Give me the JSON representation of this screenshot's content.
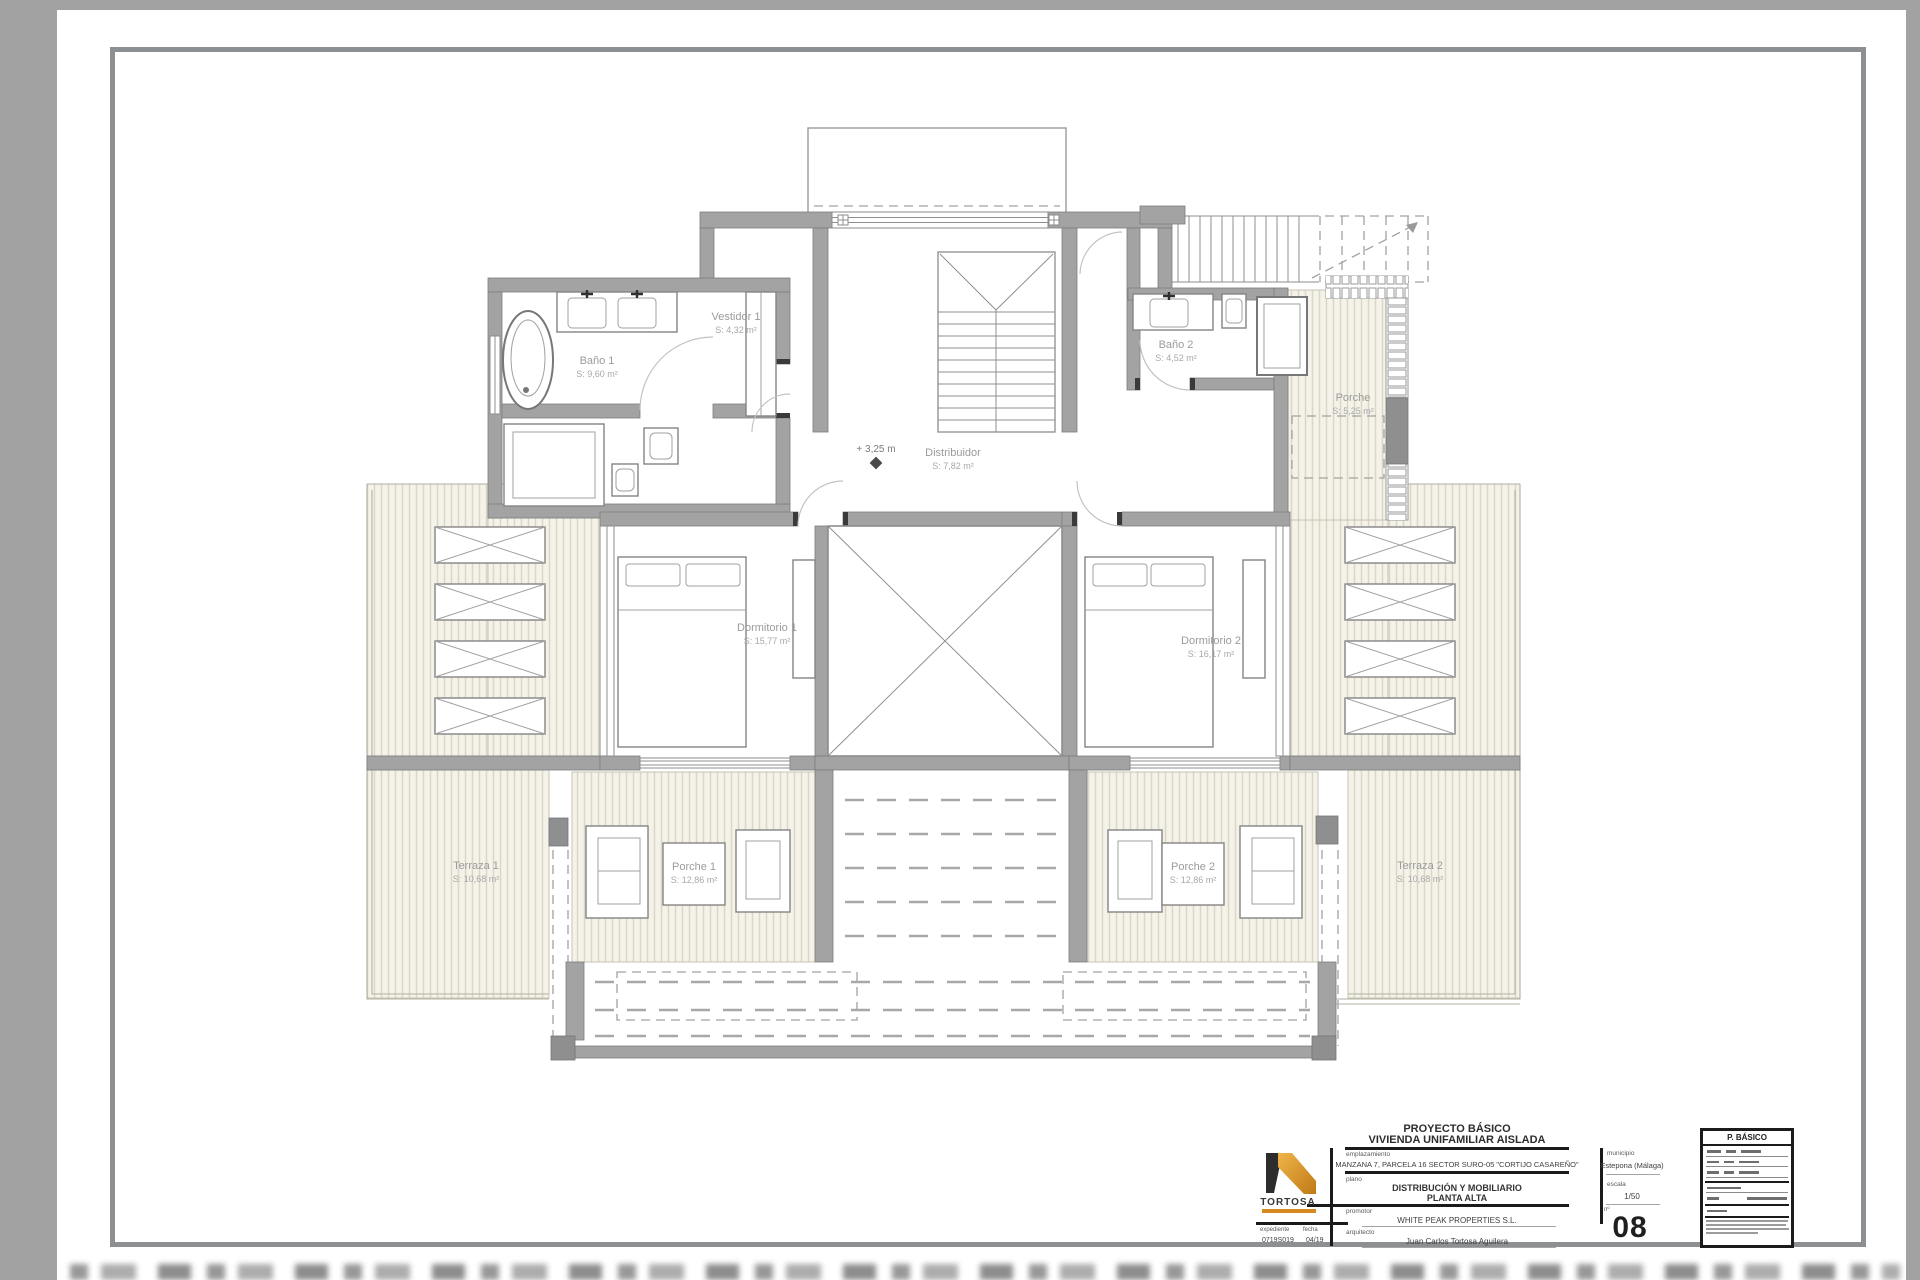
{
  "plan": {
    "rooms": [
      {
        "label": "Baño 1",
        "area": "S: 9,60 m²"
      },
      {
        "label": "Vestidor 1",
        "area": "S: 4,32 m²"
      },
      {
        "label": "Baño 2",
        "area": "S: 4,52 m²"
      },
      {
        "label": "Porche",
        "area": "S: 5,25 m²"
      },
      {
        "label": "Distribuidor",
        "area": "S: 7,82 m²"
      },
      {
        "label": "Dormitorio 1",
        "area": "S: 15,77 m²"
      },
      {
        "label": "Dormitorio 2",
        "area": "S: 16,17 m²"
      },
      {
        "label": "Terraza 1",
        "area": "S: 10,68 m²"
      },
      {
        "label": "Porche 1",
        "area": "S: 12,86 m²"
      },
      {
        "label": "Porche 2",
        "area": "S: 12,86 m²"
      },
      {
        "label": "Terraza 2",
        "area": "S: 10,68 m²"
      }
    ],
    "level_marker": "+ 3,25 m"
  },
  "title_block": {
    "project_line1": "PROYECTO BÁSICO",
    "project_line2": "VIVIENDA UNIFAMILIAR AISLADA",
    "emplazamiento_label": "emplazamiento",
    "emplazamiento_value": "MANZANA 7, PARCELA 16 SECTOR SURO-05 \"CORTIJO CASAREÑO\"",
    "plano_label": "plano",
    "plano_value_line1": "DISTRIBUCIÓN Y MOBILIARIO",
    "plano_value_line2": "PLANTA ALTA",
    "promotor_label": "promotor",
    "promotor_value": "WHITE PEAK PROPERTIES S.L.",
    "arquitecto_label": "arquitecto",
    "arquitecto_value": "Juan Carlos Tortosa Aguilera",
    "municipio_label": "municipio",
    "municipio_value": "Estepona (Málaga)",
    "escala_label": "escala",
    "escala_value": "1/50",
    "numero_label": "nº",
    "numero_value": "08",
    "expediente_label": "expediente",
    "expediente_value": "0719S019",
    "fecha_label": "fecha",
    "fecha_value": "04/19",
    "logo_text": "TORTOSA",
    "stamp_header": "P. BÁSICO"
  },
  "colors": {
    "accent_orange": "#d7891f",
    "wall_gray": "#a3a3a3",
    "hatch_bg": "#f4f2e9",
    "frame_gray": "#8d9093"
  }
}
